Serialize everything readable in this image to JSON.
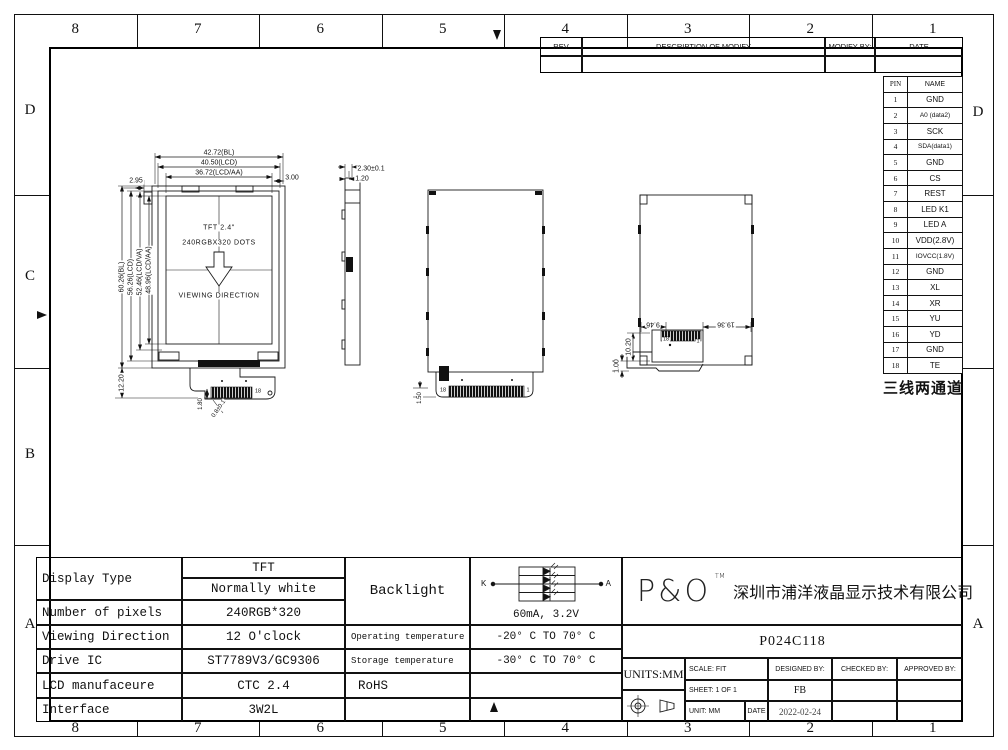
{
  "frame": {
    "columns": [
      "8",
      "7",
      "6",
      "5",
      "4",
      "3",
      "2",
      "1"
    ],
    "left_rows": [
      "D",
      "C",
      "B",
      "A"
    ],
    "right_rows": [
      "D",
      "A"
    ]
  },
  "rev_table": {
    "col_rev": "REV",
    "col_desc": "DESCRIPTION OF MODIFY",
    "col_by": "MODIFY BY:",
    "col_date": "DATE"
  },
  "pin_table": {
    "header_pin": "PIN",
    "header_name": "NAME",
    "rows": [
      [
        "1",
        "GND"
      ],
      [
        "2",
        "A0 (data2)"
      ],
      [
        "3",
        "SCK"
      ],
      [
        "4",
        "SDA(data1)"
      ],
      [
        "5",
        "GND"
      ],
      [
        "6",
        "CS"
      ],
      [
        "7",
        "REST"
      ],
      [
        "8",
        "LED K1"
      ],
      [
        "9",
        "LED A"
      ],
      [
        "10",
        "VDD(2.8V)"
      ],
      [
        "11",
        "IOVCC(1.8V)"
      ],
      [
        "12",
        "GND"
      ],
      [
        "13",
        "XL"
      ],
      [
        "14",
        "XR"
      ],
      [
        "15",
        "YU"
      ],
      [
        "16",
        "YD"
      ],
      [
        "17",
        "GND"
      ],
      [
        "18",
        "TE"
      ]
    ],
    "note": "三线两通道"
  },
  "front_view": {
    "line1": "TFT 2.4\"",
    "line2": "240RGBX320 DOTS",
    "line3": "VIEWING DIRECTION"
  },
  "annotations": [
    {
      "t": "42.72(BL)",
      "x": 219,
      "y": 153,
      "s": 7
    },
    {
      "t": "40.50(LCD)",
      "x": 219,
      "y": 163,
      "s": 7
    },
    {
      "t": "36.72(LCD/AA)",
      "x": 219,
      "y": 173,
      "s": 7
    },
    {
      "t": "2.95",
      "x": 136,
      "y": 181,
      "s": 7
    },
    {
      "t": "3.00",
      "x": 292,
      "y": 178,
      "s": 7
    },
    {
      "t": "60.26(BL)",
      "x": 122,
      "y": 277,
      "s": 7,
      "r": -90
    },
    {
      "t": "56.26(LCD)",
      "x": 131,
      "y": 277,
      "s": 7,
      "r": -90
    },
    {
      "t": "52.46(LCD/VA)",
      "x": 140,
      "y": 272,
      "s": 7,
      "r": -90
    },
    {
      "t": "48.96(LCD/AA)",
      "x": 149,
      "y": 270,
      "s": 7,
      "r": -90
    },
    {
      "t": "12.20",
      "x": 122,
      "y": 383,
      "s": 7,
      "r": -90
    },
    {
      "t": "1.80",
      "x": 201,
      "y": 404,
      "s": 6,
      "r": -90
    },
    {
      "t": "0.8±0.1",
      "x": 219,
      "y": 409,
      "s": 6,
      "r": -55
    },
    {
      "t": "18",
      "x": 258,
      "y": 392,
      "s": 5.5
    },
    {
      "t": "2.30±0.1",
      "x": 371,
      "y": 169,
      "s": 7
    },
    {
      "t": "1.20",
      "x": 362,
      "y": 179,
      "s": 7
    },
    {
      "t": "1.50",
      "x": 420,
      "y": 398,
      "s": 6,
      "r": -90
    },
    {
      "t": "18",
      "x": 443,
      "y": 391,
      "s": 5.5
    },
    {
      "t": "1",
      "x": 528,
      "y": 391,
      "s": 5.5
    },
    {
      "t": "9.46",
      "x": 653,
      "y": 324,
      "s": 7,
      "r": 180
    },
    {
      "t": "19.36",
      "x": 726,
      "y": 324,
      "s": 7,
      "r": 180
    },
    {
      "t": "10.20",
      "x": 629,
      "y": 347,
      "s": 7,
      "r": -90
    },
    {
      "t": "1.00",
      "x": 617,
      "y": 366,
      "s": 7,
      "r": -90
    },
    {
      "t": "18",
      "x": 666,
      "y": 340,
      "s": 5.5
    },
    {
      "t": "1",
      "x": 698,
      "y": 342,
      "s": 5.5
    }
  ],
  "spec_table": {
    "display_type_label": "Display Type",
    "display_type_1": "TFT",
    "display_type_2": "Normally white",
    "pixels_label": "Number of pixels",
    "pixels_value": "240RGB*320",
    "viewing_label": "Viewing Direction",
    "viewing_value": "12 O'clock",
    "drive_label": "Drive IC",
    "drive_value": "ST7789V3/GC9306",
    "mfr_label": "LCD manufaceure",
    "mfr_value": "CTC 2.4",
    "interface_label": "Interface",
    "interface_value": "3W2L"
  },
  "backlight": {
    "label": "Backlight",
    "k": "K",
    "a": "A",
    "rating": "60mA, 3.2V",
    "operating_label": "Operating temperature",
    "operating_value": "-20° C TO 70° C",
    "storage_label": "Storage temperature",
    "storage_value": "-30° C TO 70° C",
    "rohs": "RoHS"
  },
  "title_block": {
    "logo": "P&O",
    "tm": "TM",
    "company": "深圳市浦洋液晶显示技术有限公司",
    "part_number": "P024C118",
    "units": "UNITS:MM",
    "scale": "SCALE:  FIT",
    "designed_by": "DESIGNED BY:",
    "checked_by": "CHECKED BY:",
    "approved_by": "APPROVED BY:",
    "sheet": "SHEET:  1  OF  1",
    "designer": "FB",
    "unit": "UNIT:  MM",
    "date_label": "DATE",
    "date_value": "2022-02-24"
  }
}
